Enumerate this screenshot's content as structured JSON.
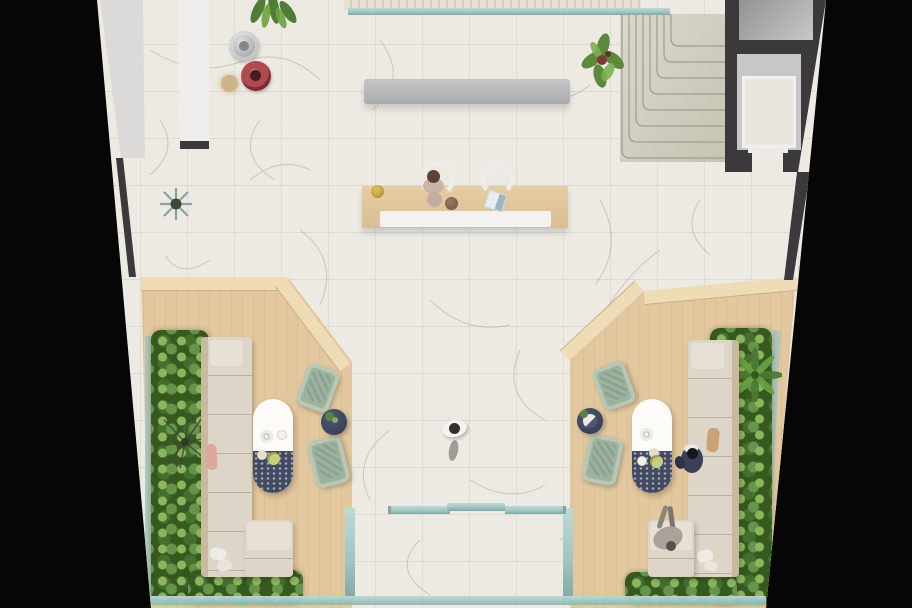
{
  "scene": {
    "type": "architectural-floor-plan-render",
    "view": "top-down lobby amenity level, perspective-trapezoid footprint on black background",
    "areas": [
      "central marble lobby with veined white tile",
      "grand corner staircase upper right",
      "elevator and service rooms along right wall",
      "two partition walls upper left",
      "reception desk with two chairs and receptionist",
      "long concrete bench",
      "left lounge platform in light oak wood",
      "right lounge platform in light oak wood",
      "glass entry vestibule at bottom center",
      "perimeter planters with dense foliage"
    ],
    "objects": {
      "sofas": 2,
      "chaise_ottomans": 2,
      "oval_coffee_tables": 2,
      "sage_armchairs": 4,
      "round_side_tables": 2,
      "people": 4,
      "decor_poufs": [
        "silver",
        "red"
      ],
      "plants": [
        "hanging plant",
        "stair-side plant",
        "aloe rosette",
        "palm",
        "dry branch",
        "planter hedges"
      ]
    }
  },
  "palette": {
    "bg": "#060606",
    "marble": "#edeae4",
    "marble-vein": "#b5a795",
    "wood": "#e3c89f",
    "wood-step": "#eedcb6",
    "wall-dark": "#3b393b",
    "wall-face": "#dbdad8",
    "stair-light": "#dbd8cb",
    "stair-dark": "#c6c3b2",
    "stair-line": "#a7a496",
    "bench": "#b5b7b8",
    "glass": "#a3c6c3",
    "glass-dark": "#7fa8a5",
    "sofa": "#dcd5c8",
    "sofa-back": "#c9b99d",
    "sage": "#9fb29b",
    "sage-seat": "#8aa491",
    "table-white": "#fcfbf8",
    "table-navy": "#414a61",
    "leaf-light": "#8db55e",
    "leaf-mid": "#66944a",
    "leaf-dark": "#44702f",
    "leaf-deep": "#35591f",
    "pouf-silver": "#c0c3c3",
    "pouf-red": "#ae4a50",
    "gold": "#c9a84c",
    "navy-person": "#3a4156"
  }
}
